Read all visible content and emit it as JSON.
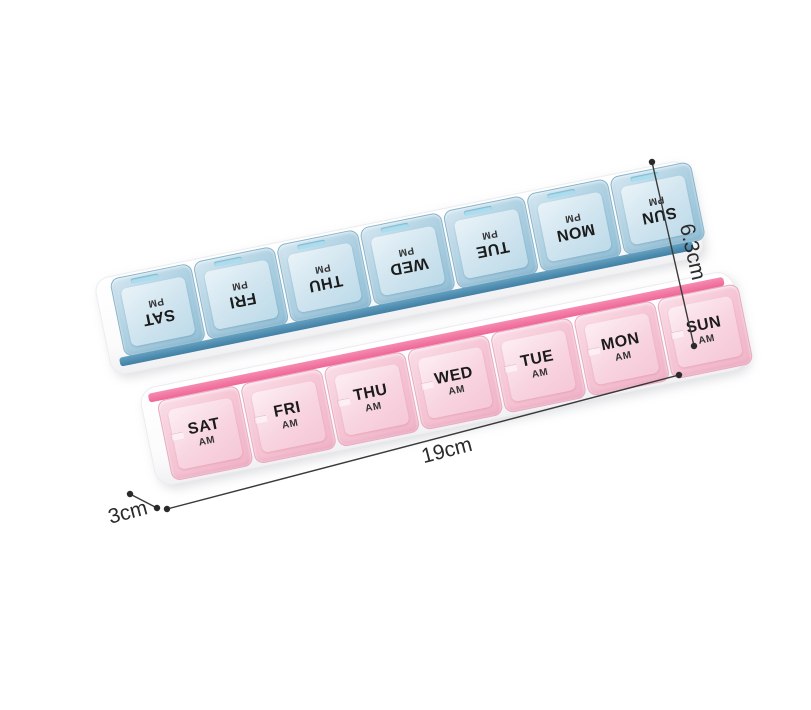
{
  "product": {
    "name": "Weekly 7-day pill organizer with AM and PM rows",
    "rows": [
      {
        "id": "pm-row",
        "strip_color": "#4e8cb0",
        "lid_color": "#b0d2e3",
        "cells": [
          {
            "day": "SAT",
            "period": "PM"
          },
          {
            "day": "FRI",
            "period": "PM"
          },
          {
            "day": "THU",
            "period": "PM"
          },
          {
            "day": "WED",
            "period": "PM"
          },
          {
            "day": "TUE",
            "period": "PM"
          },
          {
            "day": "MON",
            "period": "PM"
          },
          {
            "day": "SUN",
            "period": "PM"
          }
        ]
      },
      {
        "id": "am-row",
        "strip_color": "#ee6796",
        "lid_color": "#f6c6d5",
        "cells": [
          {
            "day": "SAT",
            "period": "AM"
          },
          {
            "day": "FRI",
            "period": "AM"
          },
          {
            "day": "THU",
            "period": "AM"
          },
          {
            "day": "WED",
            "period": "AM"
          },
          {
            "day": "TUE",
            "period": "AM"
          },
          {
            "day": "MON",
            "period": "AM"
          },
          {
            "day": "SUN",
            "period": "AM"
          }
        ]
      }
    ]
  },
  "dimensions": {
    "height": {
      "label": "6.3cm"
    },
    "length": {
      "label": "19cm"
    },
    "depth": {
      "label": "3cm"
    }
  },
  "colors": {
    "background": "#ffffff",
    "label_text": "#1b1b1b",
    "dimension_line": "#3a3a3a"
  }
}
